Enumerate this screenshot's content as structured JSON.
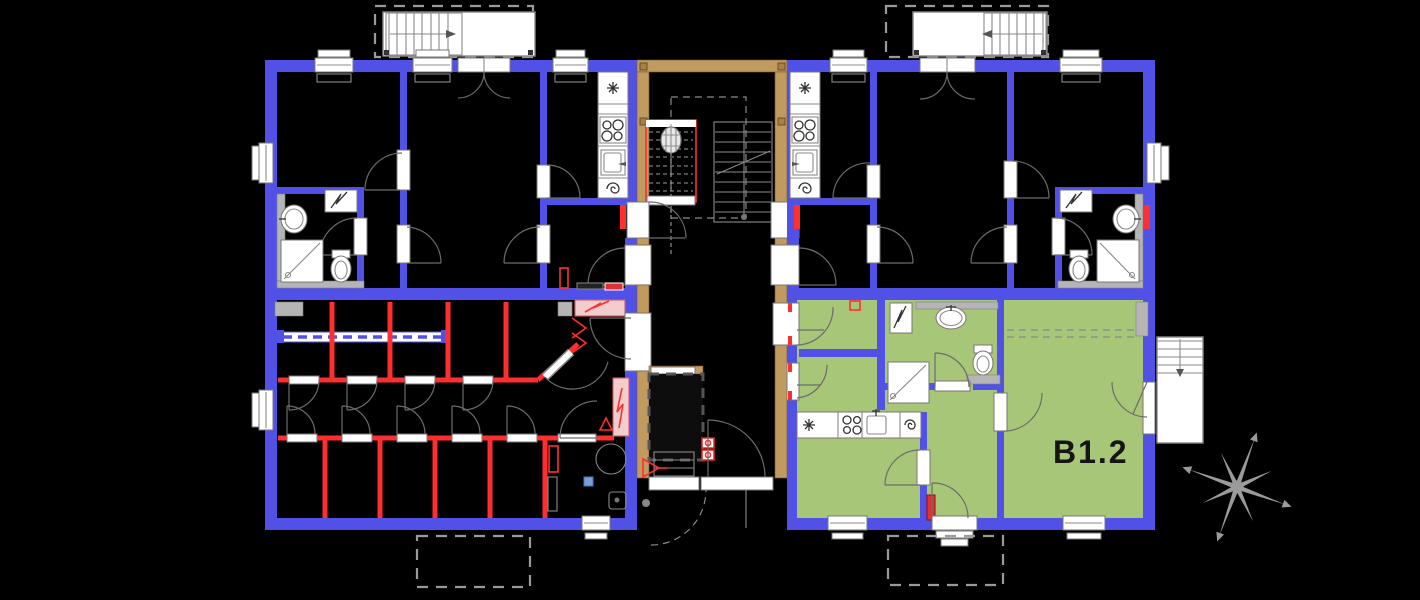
{
  "floor_plan": {
    "unit_label": "B1.2",
    "colors": {
      "background": "#000000",
      "wall_blue": "#5151e8",
      "stairwell_wall_tan": "#c09a5f",
      "storage_partition_red": "#ff2f2f",
      "unit_highlight_green": "#a8c678",
      "fixture_white": "#ffffff",
      "drawing_line_gray": "#777777",
      "electric_panel_pink": "#f3cdcd",
      "compass_gray": "#9a9a9a"
    },
    "icons": {
      "compass_rose_icon": "8-point star",
      "ceiling_light_icon": "asterisk burst",
      "boiler_spiral_icon": "spiral",
      "stove_icon": "four burner circles",
      "stair_direction_arrow_icon": "filled triangle",
      "electric_riser_icon": "lightning zigzag"
    }
  }
}
